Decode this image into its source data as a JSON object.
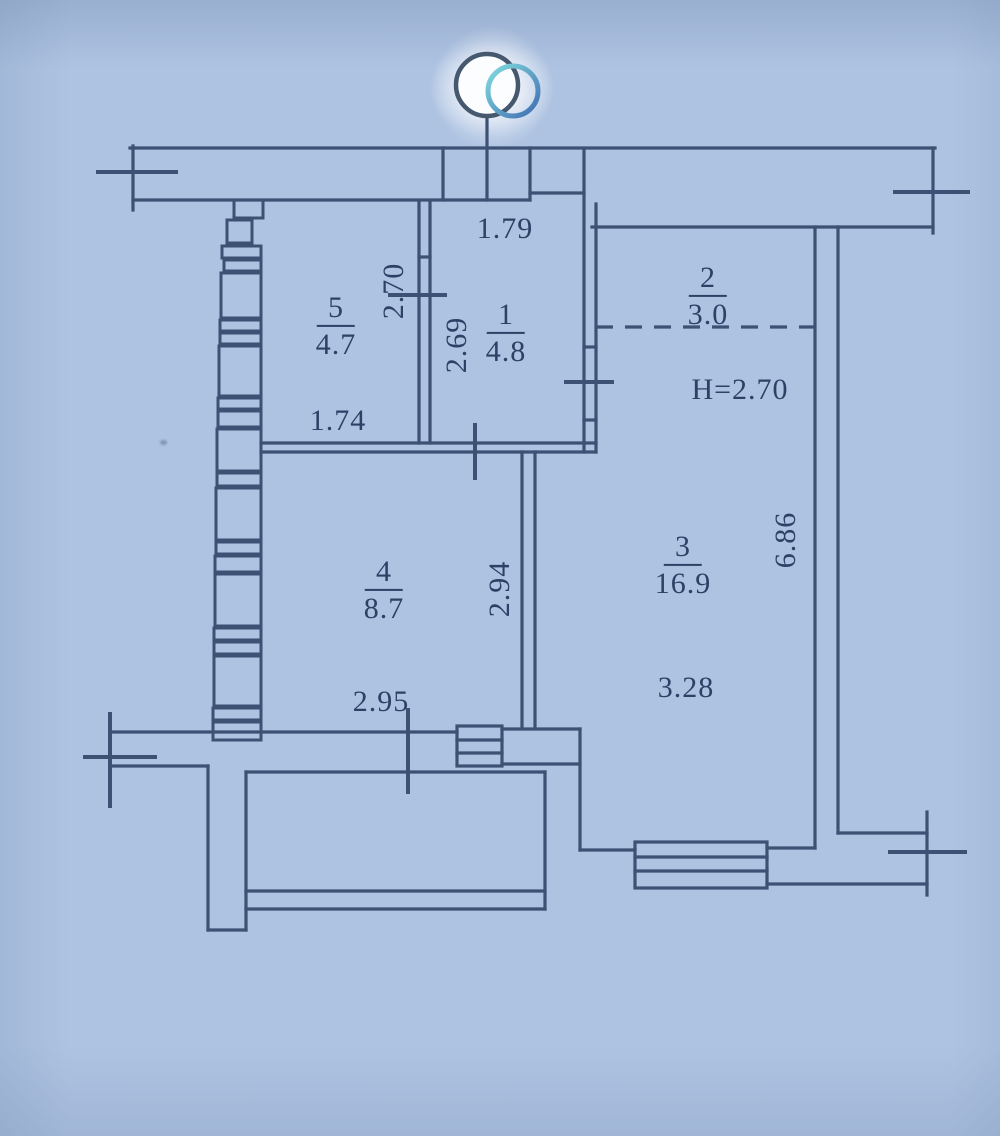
{
  "plan": {
    "rooms": [
      {
        "number": "1",
        "area": "4.8"
      },
      {
        "number": "2",
        "area": "3.0"
      },
      {
        "number": "3",
        "area": "16.9"
      },
      {
        "number": "4",
        "area": "8.7"
      },
      {
        "number": "5",
        "area": "4.7"
      }
    ],
    "dimensions": {
      "d179": "1.79",
      "d270": "2.70",
      "d269": "2.69",
      "d174": "1.74",
      "height_note": "H=2.70",
      "d686": "6.86",
      "d294": "2.94",
      "d328": "3.28",
      "d295": "2.95"
    },
    "colors": {
      "background": "#aec3e2",
      "line": "#3c5173",
      "text": "#2c4166",
      "logo_fill": "#fbfdff",
      "logo_outline": "#45586e",
      "logo_ring_teal": "#83dcdf",
      "logo_ring_blue": "#3f6db2"
    }
  }
}
